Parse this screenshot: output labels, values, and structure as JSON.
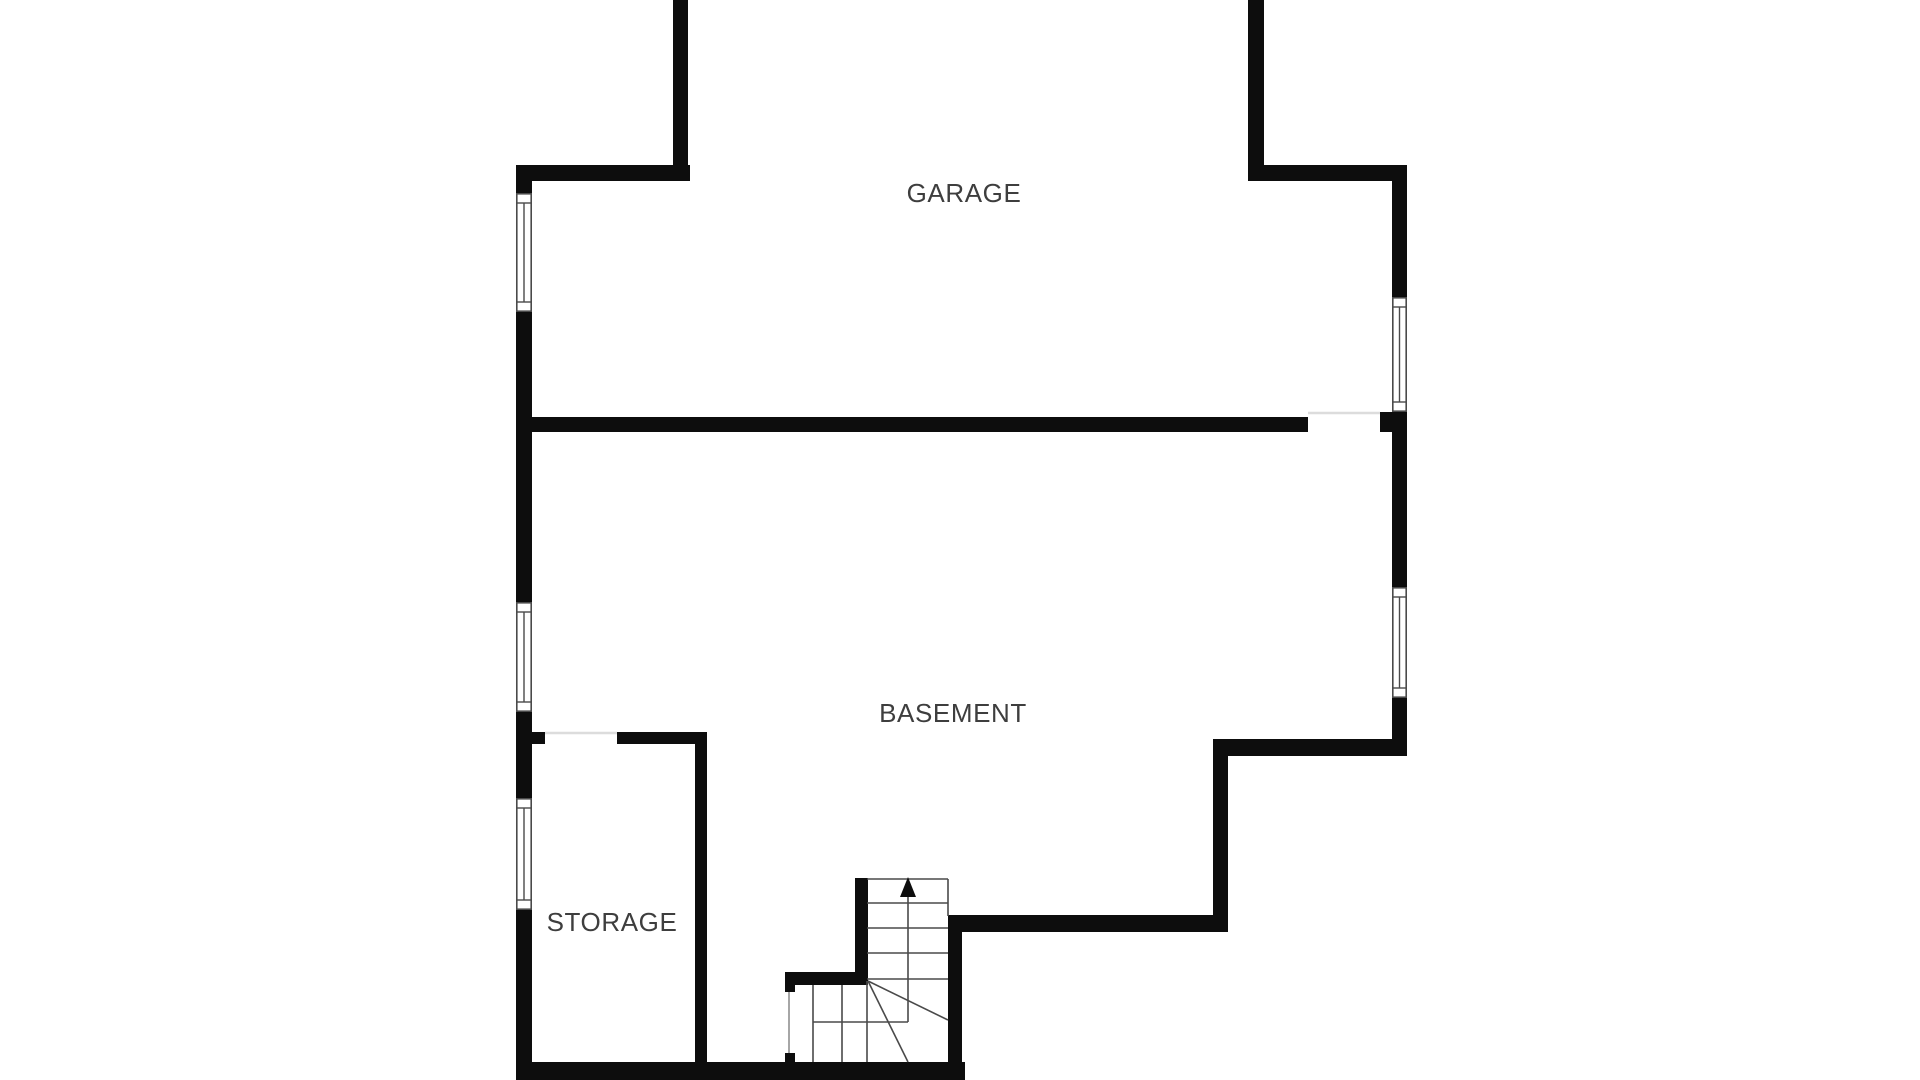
{
  "page": {
    "type": "floor-plan",
    "level": "basement-level"
  },
  "colors": {
    "background": "#ffffff",
    "wall": "#0d0d0d",
    "line": "#4a4a4a",
    "text": "#3e3e3e",
    "threshold": "#dcdcdc",
    "doorline": "#8f8f8f"
  },
  "rooms": [
    {
      "id": "garage",
      "label": "GARAGE"
    },
    {
      "id": "basement",
      "label": "BASEMENT"
    },
    {
      "id": "storage",
      "label": "STORAGE"
    }
  ],
  "stairs": {
    "type": "winder-staircase",
    "direction": "up",
    "straight_treads": 5,
    "winder_treads": 6
  },
  "openings": {
    "windows_left_wall": 3,
    "windows_right_wall": 2,
    "doorways": 3,
    "garage_opening_top": 1
  }
}
